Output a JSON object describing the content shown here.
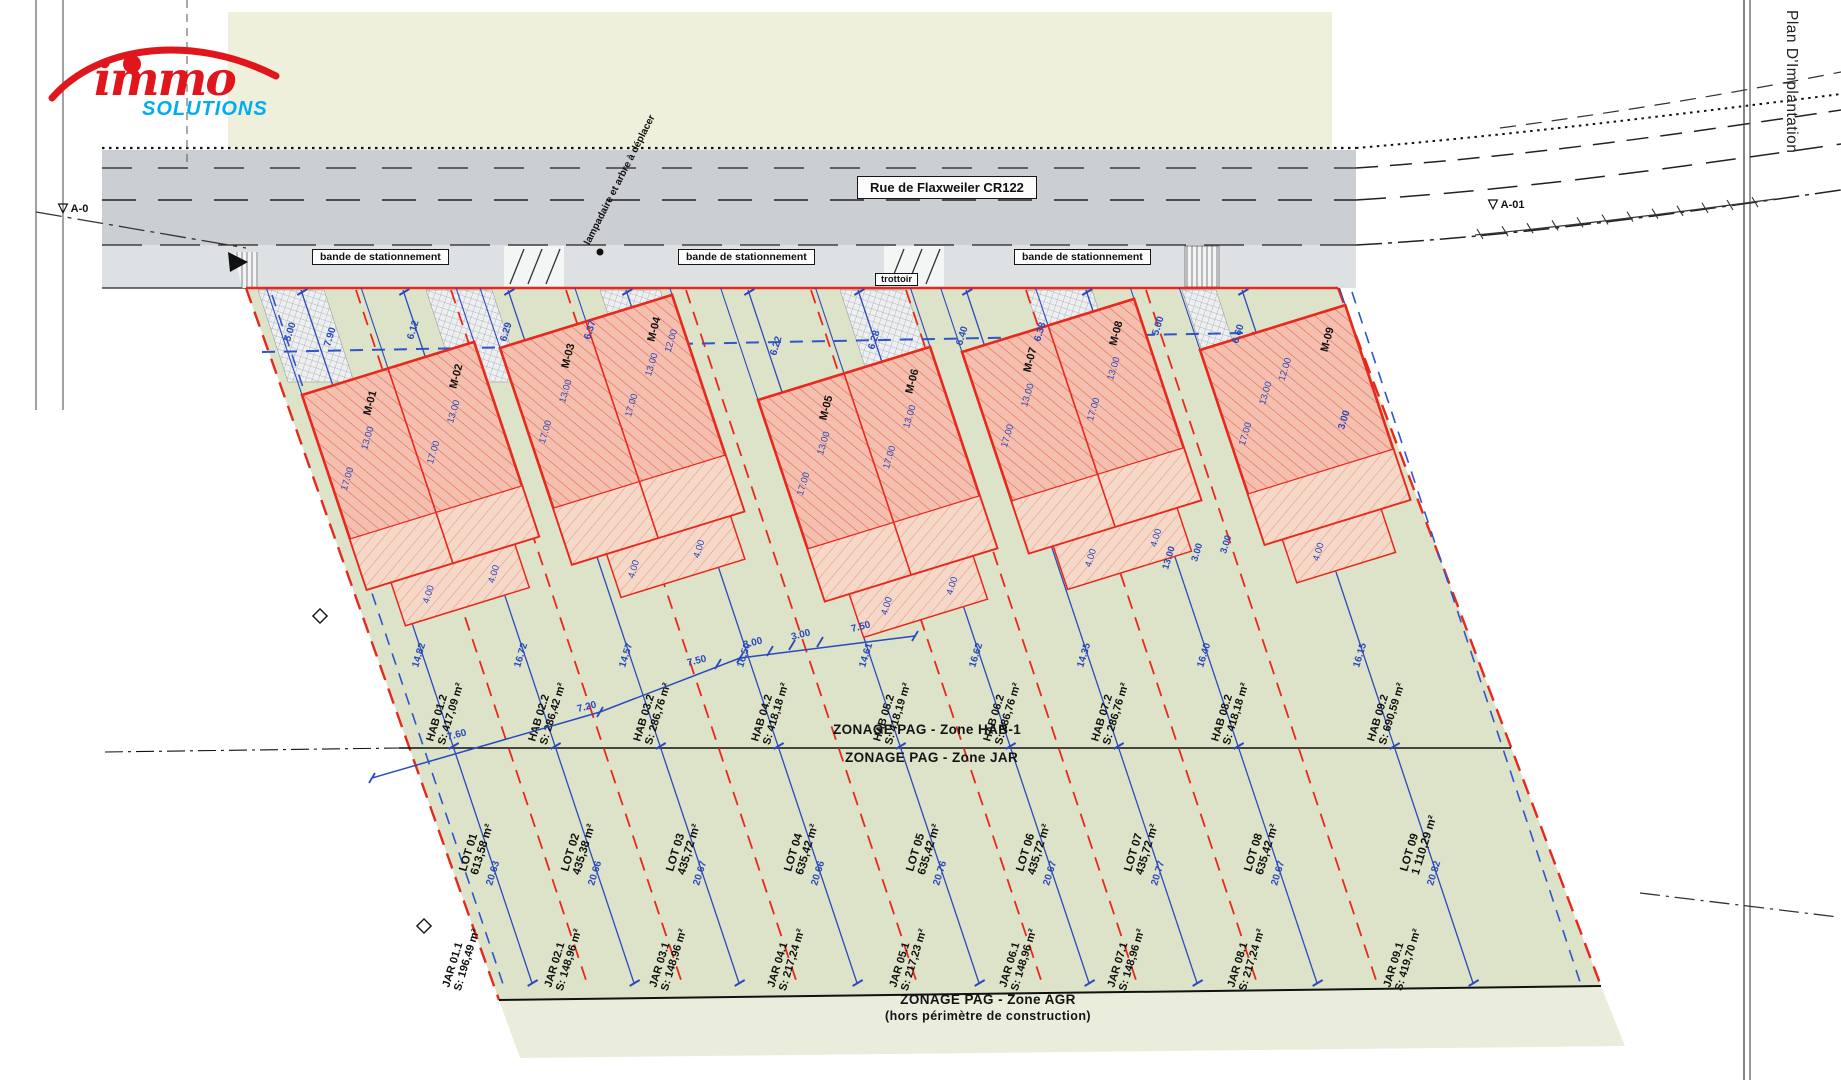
{
  "sheet": {
    "plan_title": "Plan D'Implantation"
  },
  "logo": {
    "immo": "immo",
    "solutions": "SOLUTIONS"
  },
  "street": {
    "name": "Rue de Flaxweiler CR122"
  },
  "road": {
    "parking": "bande de stationnement",
    "sidewalk": "trottoir",
    "note": "lampadaire et arbre à déplacer"
  },
  "markers": {
    "right": "A-01",
    "left": "A-0"
  },
  "zoning": {
    "hab": "ZONAGE PAG - Zone HAB-1",
    "jar": "ZONAGE PAG - Zone JAR",
    "agr": "ZONAGE PAG - Zone AGR",
    "agr_sub": "(hors périmètre de construction)"
  },
  "houses": {
    "names": [
      "M-01",
      "M-02",
      "M-03",
      "M-04",
      "M-05",
      "M-06",
      "M-07",
      "M-08",
      "M-09"
    ],
    "dim_long": "17.00",
    "dim_short": "13.00",
    "dim_mid": "12.00",
    "terrace_dim": "4.00"
  },
  "lots": [
    {
      "lot": "LOT 01",
      "lot_area": "613,58 m²",
      "hab": "HAB 01.2",
      "hab_area": "S: 417,09 m²",
      "jar": "JAR 01.1",
      "jar_area": "S: 196,49 m²",
      "dim_hab": "14.82",
      "dim_jar": "20.63"
    },
    {
      "lot": "LOT 02",
      "lot_area": "435,38 m²",
      "hab": "HAB 02.2",
      "hab_area": "S: 286,42 m²",
      "jar": "JAR 02.1",
      "jar_area": "S: 148,96 m²",
      "dim_hab": "16.72",
      "dim_jar": "20.66"
    },
    {
      "lot": "LOT 03",
      "lot_area": "435,72 m²",
      "hab": "HAB 03.2",
      "hab_area": "S: 286,76 m²",
      "jar": "JAR 03.1",
      "jar_area": "S: 148,96 m²",
      "dim_hab": "14.57",
      "dim_jar": "20.67"
    },
    {
      "lot": "LOT 04",
      "lot_area": "635,42 m²",
      "hab": "HAB 04.2",
      "hab_area": "S: 418,18 m²",
      "jar": "JAR 04.1",
      "jar_area": "S: 217,24 m²",
      "dim_hab": "16.50",
      "dim_jar": "20.66"
    },
    {
      "lot": "LOT 05",
      "lot_area": "635,42 m²",
      "hab": "HAB 05.2",
      "hab_area": "S: 418,19 m²",
      "jar": "JAR 05.1",
      "jar_area": "S: 217,23 m²",
      "dim_hab": "14.61",
      "dim_jar": "20.76"
    },
    {
      "lot": "LOT 06",
      "lot_area": "435,72 m²",
      "hab": "HAB 06.2",
      "hab_area": "S: 286,76 m²",
      "jar": "JAR 06.1",
      "jar_area": "S: 148,96 m²",
      "dim_hab": "16.62",
      "dim_jar": "20.67"
    },
    {
      "lot": "LOT 07",
      "lot_area": "435,72 m²",
      "hab": "HAB 07.2",
      "hab_area": "S: 286,76 m²",
      "jar": "JAR 07.1",
      "jar_area": "S: 148,96 m²",
      "dim_hab": "14.35",
      "dim_jar": "20.77"
    },
    {
      "lot": "LOT 08",
      "lot_area": "635,42 m²",
      "hab": "HAB 08.2",
      "hab_area": "S: 418,18 m²",
      "jar": "JAR 08.1",
      "jar_area": "S: 217,24 m²",
      "dim_hab": "16.40",
      "dim_jar": "20.67"
    },
    {
      "lot": "LOT 09",
      "lot_area": "1 110,29 m²",
      "hab": "HAB 09.2",
      "hab_area": "S: 690,59 m²",
      "jar": "JAR 09.1",
      "jar_area": "S: 419,70 m²",
      "dim_hab": "16.15",
      "dim_jar": "20.82"
    }
  ],
  "front_dims": [
    "5.00",
    "7.90",
    "6.12",
    "6.29",
    "6.37",
    "6.22",
    "6.28",
    "6.40",
    "6.38",
    "5.00",
    "6.60",
    "3.00"
  ],
  "traverse_dims": [
    "7.60",
    "7.20",
    "7.50",
    "3.00",
    "3.00",
    "7.50"
  ],
  "cluster_dims": [
    "13.00",
    "3.00",
    "3.00"
  ],
  "colors": {
    "site_green": "#dce3c8",
    "agr_cream": "#ebeddc",
    "street_gray": "#cbcfd3",
    "parking_gray": "#dee1e3",
    "top_cream": "#eef0dc",
    "red": "#e8281c",
    "house_fill": "#f4bfae",
    "blue": "#2a49bd",
    "logo_red": "#e0161c",
    "logo_blue": "#00aeef"
  }
}
